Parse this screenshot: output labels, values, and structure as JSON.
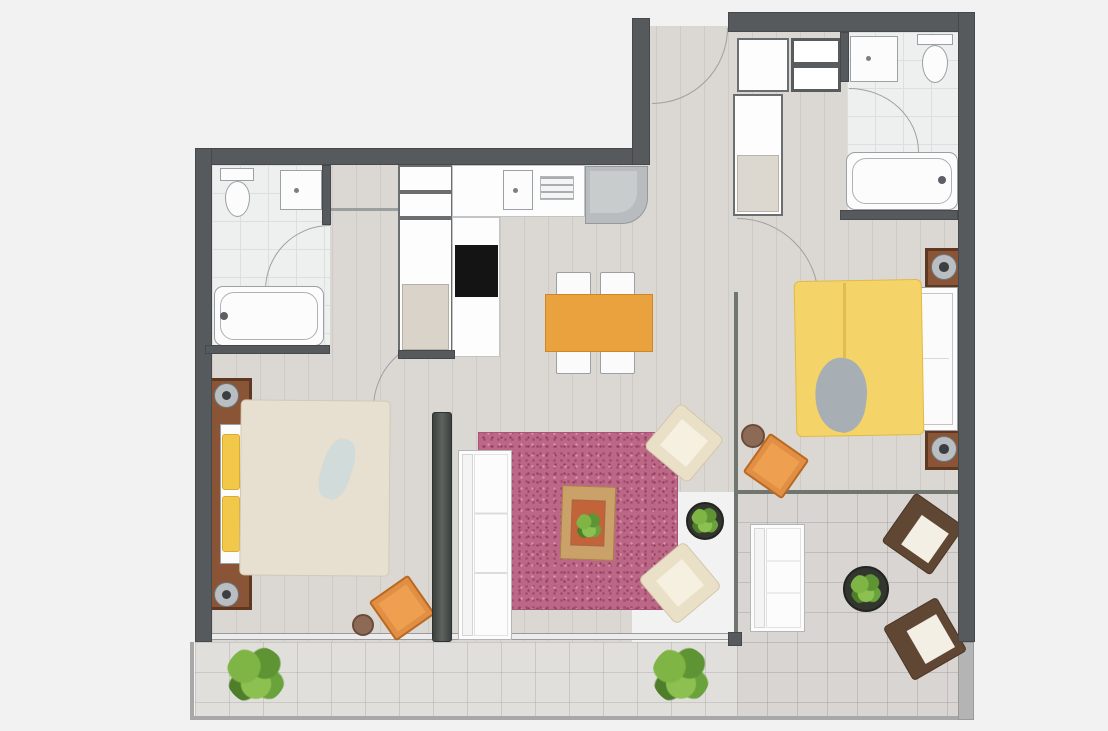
{
  "meta": {
    "kind": "apartment-floor-plan",
    "canvas": {
      "w": 1108,
      "h": 731
    },
    "background": "#f2f2f3"
  },
  "palette": {
    "wall": "#565a5d",
    "wood_floor": "#dbd7d2",
    "bath_tile": "#eef0f0",
    "terrace_tile": "#d8d5d2",
    "rug_pink": "#bd6787",
    "duvet_yellow": "#f4d469",
    "duvet_beige": "#e7e0d0",
    "accent_orange": "#e9a23e",
    "furniture_brown": "#5f4733",
    "plant_green": "#7fb544"
  },
  "scene": {
    "items": [
      {
        "name": "floor-left-wing",
        "cls": "floor-wood",
        "x": 212,
        "y": 165,
        "w": 420,
        "h": 477
      },
      {
        "name": "floor-right-wing",
        "cls": "floor-wood",
        "x": 632,
        "y": 26,
        "w": 326,
        "h": 466
      },
      {
        "name": "floor-bathroom-1",
        "cls": "floor-bath",
        "x": 212,
        "y": 165,
        "w": 118,
        "h": 182
      },
      {
        "name": "floor-bathroom-2",
        "cls": "floor-bath",
        "x": 847,
        "y": 32,
        "w": 111,
        "h": 182
      },
      {
        "name": "floor-terrace",
        "cls": "floor-terrace",
        "x": 737,
        "y": 492,
        "w": 221,
        "h": 226
      },
      {
        "name": "floor-balcony",
        "cls": "floor-balcony",
        "x": 195,
        "y": 642,
        "w": 542,
        "h": 76
      },
      {
        "name": "balcony-railing-left",
        "cls": "rail",
        "x": 190,
        "y": 642,
        "w": 4,
        "h": 78
      },
      {
        "name": "balcony-railing-bottom",
        "cls": "rail",
        "x": 190,
        "y": 716,
        "w": 772,
        "h": 4
      },
      {
        "name": "terrace-wall-right",
        "cls": "wall-light",
        "x": 958,
        "y": 642,
        "w": 16,
        "h": 78
      },
      {
        "name": "bedroom1-window",
        "cls": "window-line",
        "x": 212,
        "y": 633,
        "w": 220,
        "h": 7
      },
      {
        "name": "living-window",
        "cls": "window-line",
        "x": 452,
        "y": 633,
        "w": 281,
        "h": 7
      },
      {
        "name": "partition-living-terrace",
        "cls": "glass-line",
        "x": 734,
        "y": 292,
        "w": 4,
        "h": 348
      },
      {
        "name": "partition-bedroom2-terrace",
        "cls": "glass-line",
        "x": 738,
        "y": 490,
        "w": 220,
        "h": 4
      },
      {
        "name": "partition-post",
        "cls": "wall",
        "x": 728,
        "y": 632,
        "w": 14,
        "h": 14
      },
      {
        "name": "entrance-door-arc",
        "cls": "arc arc-tl",
        "x": 652,
        "y": 28,
        "w": 76,
        "h": 76
      },
      {
        "name": "bath1-door-arc",
        "cls": "arc arc-br",
        "x": 265,
        "y": 225,
        "w": 65,
        "h": 65
      },
      {
        "name": "bath2-door-arc",
        "cls": "arc arc-bl",
        "x": 849,
        "y": 88,
        "w": 70,
        "h": 64
      },
      {
        "name": "bedroom2-door-arc",
        "cls": "arc arc-bl",
        "x": 737,
        "y": 218,
        "w": 82,
        "h": 82
      },
      {
        "name": "bedroom1-door-arc",
        "cls": "arc arc-br",
        "x": 373,
        "y": 338,
        "w": 70,
        "h": 70
      },
      {
        "name": "toilet1-tank",
        "cls": "white-item",
        "x": 220,
        "y": 168,
        "w": 34,
        "h": 13
      },
      {
        "name": "toilet1-bowl",
        "cls": "white-item toilet-bowl",
        "x": 225,
        "y": 181,
        "w": 25,
        "h": 36
      },
      {
        "name": "bathroom1-sink",
        "cls": "white-item sink",
        "x": 280,
        "y": 170,
        "w": 42,
        "h": 40
      },
      {
        "name": "bathtub-1",
        "cls": "white-item tub",
        "x": 214,
        "y": 286,
        "w": 110,
        "h": 60
      },
      {
        "name": "bathtub1-faucet",
        "cls": "dark-dot",
        "x": 220,
        "y": 312,
        "w": 8,
        "h": 8
      },
      {
        "name": "hall-closet-shelf-a",
        "cls": "outline-item",
        "x": 398,
        "y": 165,
        "w": 55,
        "h": 27
      },
      {
        "name": "hall-closet-shelf-b",
        "cls": "outline-item",
        "x": 398,
        "y": 192,
        "w": 55,
        "h": 26
      },
      {
        "name": "hall-wardrobe",
        "cls": "outline-item",
        "x": 398,
        "y": 218,
        "w": 55,
        "h": 136
      },
      {
        "name": "hall-wardrobe-interior",
        "cls": "soft-fill",
        "x": 402,
        "y": 284,
        "w": 47,
        "h": 66,
        "bg": "#d9d3c9"
      },
      {
        "name": "hall-doorway-lintel",
        "cls": "thin-line",
        "x": 330,
        "y": 208,
        "w": 68,
        "h": 3
      },
      {
        "name": "kitchen-counter",
        "cls": "counter",
        "x": 452,
        "y": 165,
        "w": 133,
        "h": 52
      },
      {
        "name": "kitchen-counter-column",
        "cls": "counter",
        "x": 452,
        "y": 217,
        "w": 48,
        "h": 140
      },
      {
        "name": "kitchen-oven",
        "cls": "black-box",
        "x": 455,
        "y": 245,
        "w": 43,
        "h": 52
      },
      {
        "name": "kitchen-sink",
        "cls": "white-item sink",
        "x": 503,
        "y": 170,
        "w": 30,
        "h": 40
      },
      {
        "name": "kitchen-vent-grill",
        "cls": "grill",
        "x": 540,
        "y": 176,
        "w": 34,
        "h": 24
      },
      {
        "name": "kitchen-stove",
        "cls": "stove",
        "x": 585,
        "y": 166,
        "w": 63,
        "h": 58
      },
      {
        "name": "dining-chair-1",
        "cls": "chair-white",
        "x": 556,
        "y": 272,
        "w": 35,
        "h": 24
      },
      {
        "name": "dining-chair-2",
        "cls": "chair-white",
        "x": 600,
        "y": 272,
        "w": 35,
        "h": 24
      },
      {
        "name": "dining-chair-3",
        "cls": "chair-white",
        "x": 556,
        "y": 350,
        "w": 35,
        "h": 24
      },
      {
        "name": "dining-chair-4",
        "cls": "chair-white",
        "x": 600,
        "y": 350,
        "w": 35,
        "h": 24
      },
      {
        "name": "dining-table",
        "cls": "table-orange",
        "x": 545,
        "y": 294,
        "w": 108,
        "h": 58
      },
      {
        "name": "entry-closet-cabinet",
        "cls": "outline-item",
        "x": 737,
        "y": 38,
        "w": 52,
        "h": 54
      },
      {
        "name": "entry-closet-shelves",
        "cls": "shelves",
        "x": 791,
        "y": 38,
        "w": 50,
        "h": 54
      },
      {
        "name": "entry-wardrobe",
        "cls": "outline-item",
        "x": 733,
        "y": 94,
        "w": 50,
        "h": 122
      },
      {
        "name": "entry-wardrobe-interior",
        "cls": "soft-fill",
        "x": 737,
        "y": 155,
        "w": 42,
        "h": 57,
        "bg": "#ddd8cf"
      },
      {
        "name": "bathroom2-sink",
        "cls": "white-item sink",
        "x": 850,
        "y": 36,
        "w": 48,
        "h": 46
      },
      {
        "name": "toilet2-tank",
        "cls": "white-item",
        "x": 917,
        "y": 34,
        "w": 36,
        "h": 11
      },
      {
        "name": "toilet2-bowl",
        "cls": "white-item toilet-bowl",
        "x": 922,
        "y": 45,
        "w": 26,
        "h": 38
      },
      {
        "name": "bathtub-2",
        "cls": "white-item tub",
        "x": 846,
        "y": 152,
        "w": 112,
        "h": 58
      },
      {
        "name": "bathtub2-faucet",
        "cls": "dark-dot",
        "x": 938,
        "y": 176,
        "w": 8,
        "h": 8
      },
      {
        "name": "nightstand-1",
        "cls": "nightstand",
        "x": 925,
        "y": 248,
        "w": 38,
        "h": 40
      },
      {
        "name": "nightstand-lamp-1",
        "cls": "lamp",
        "x": 931,
        "y": 254,
        "w": 26,
        "h": 26
      },
      {
        "name": "nightstand-2",
        "cls": "nightstand",
        "x": 925,
        "y": 430,
        "w": 38,
        "h": 40
      },
      {
        "name": "nightstand-lamp-2",
        "cls": "lamp",
        "x": 931,
        "y": 436,
        "w": 26,
        "h": 26
      },
      {
        "name": "bed2-mattress",
        "cls": "white-item",
        "x": 910,
        "y": 287,
        "w": 48,
        "h": 144
      },
      {
        "name": "bed2-pillows",
        "cls": "pillow",
        "x": 913,
        "y": 293,
        "w": 40,
        "h": 132
      },
      {
        "name": "bed2-duvet",
        "cls": "duvet-yellow",
        "x": 795,
        "y": 280,
        "w": 128,
        "h": 156,
        "rot": -1
      },
      {
        "name": "bed2-duvet-fold",
        "cls": "fold-line",
        "x": 843,
        "y": 283,
        "w": 3,
        "h": 150
      },
      {
        "name": "bed2-throw",
        "cls": "throw-gray",
        "x": 815,
        "y": 358,
        "w": 52,
        "h": 74,
        "rot": 8
      },
      {
        "name": "pouf-2",
        "cls": "pouf",
        "x": 741,
        "y": 424,
        "w": 24,
        "h": 24
      },
      {
        "name": "armchair-orange-2",
        "cls": "chair-orange",
        "x": 752,
        "y": 442,
        "w": 48,
        "h": 48,
        "rot": 35
      },
      {
        "name": "bed1-headboard",
        "cls": "nightstand",
        "x": 208,
        "y": 378,
        "w": 44,
        "h": 232
      },
      {
        "name": "bed1-lamp-1",
        "cls": "lamp",
        "x": 214,
        "y": 383,
        "w": 25,
        "h": 25
      },
      {
        "name": "bed1-lamp-2",
        "cls": "lamp",
        "x": 214,
        "y": 582,
        "w": 25,
        "h": 25
      },
      {
        "name": "bed1-mattress",
        "cls": "white-item",
        "x": 220,
        "y": 424,
        "w": 44,
        "h": 140
      },
      {
        "name": "bed1-pillow-1",
        "cls": "pillow-yellow",
        "x": 222,
        "y": 434,
        "w": 18,
        "h": 56
      },
      {
        "name": "bed1-pillow-2",
        "cls": "pillow-yellow",
        "x": 222,
        "y": 496,
        "w": 18,
        "h": 56
      },
      {
        "name": "bed1-duvet",
        "cls": "duvet-beige",
        "x": 240,
        "y": 400,
        "w": 150,
        "h": 176,
        "rot": 0.5
      },
      {
        "name": "bed1-throw",
        "cls": "throw-blue",
        "x": 322,
        "y": 438,
        "w": 30,
        "h": 62,
        "rot": 18
      },
      {
        "name": "armchair-orange-1",
        "cls": "chair-orange",
        "x": 378,
        "y": 584,
        "w": 48,
        "h": 48,
        "rot": -35
      },
      {
        "name": "pouf-1",
        "cls": "pouf",
        "x": 352,
        "y": 614,
        "w": 22,
        "h": 22
      },
      {
        "name": "living-rug",
        "cls": "rug",
        "x": 478,
        "y": 432,
        "w": 200,
        "h": 178
      },
      {
        "name": "sofa",
        "cls": "sofa",
        "x": 458,
        "y": 450,
        "w": 54,
        "h": 190
      },
      {
        "name": "coffee-table",
        "cls": "coffee-table",
        "x": 561,
        "y": 486,
        "w": 54,
        "h": 74,
        "rot": 2
      },
      {
        "name": "coffee-table-tray",
        "cls": "soft-fill",
        "x": 571,
        "y": 500,
        "w": 34,
        "h": 46,
        "bg": "#c2633a",
        "rot": 2
      },
      {
        "name": "coffee-table-plant",
        "cls": "plant",
        "x": 576,
        "y": 512,
        "w": 26,
        "h": 28
      },
      {
        "name": "armchair-cream-1",
        "cls": "armchair-cream",
        "x": 655,
        "y": 414,
        "w": 58,
        "h": 58,
        "rot": 40
      },
      {
        "name": "armchair-cream-2",
        "cls": "armchair-cream",
        "x": 650,
        "y": 553,
        "w": 60,
        "h": 60,
        "rot": -40
      },
      {
        "name": "living-plant-table",
        "cls": "plant-table",
        "x": 686,
        "y": 502,
        "w": 38,
        "h": 38
      },
      {
        "name": "living-plant",
        "cls": "plant",
        "x": 691,
        "y": 507,
        "w": 28,
        "h": 28
      },
      {
        "name": "tv-partition-wall",
        "cls": "tv-wall",
        "x": 432,
        "y": 412,
        "w": 20,
        "h": 230
      },
      {
        "name": "terrace-loveseat",
        "cls": "sofa",
        "x": 750,
        "y": 524,
        "w": 55,
        "h": 108
      },
      {
        "name": "terrace-plant-table",
        "cls": "plant-table",
        "x": 843,
        "y": 566,
        "w": 46,
        "h": 46
      },
      {
        "name": "terrace-plant",
        "cls": "plant",
        "x": 850,
        "y": 573,
        "w": 32,
        "h": 32
      },
      {
        "name": "armchair-brown-1",
        "cls": "armchair-brown",
        "x": 893,
        "y": 504,
        "w": 60,
        "h": 60,
        "rot": 35
      },
      {
        "name": "armchair-brown-2",
        "cls": "armchair-brown",
        "x": 894,
        "y": 608,
        "w": 62,
        "h": 62,
        "rot": -30
      },
      {
        "name": "balcony-plant-1",
        "cls": "plant",
        "x": 226,
        "y": 646,
        "w": 60,
        "h": 58
      },
      {
        "name": "balcony-plant-2",
        "cls": "plant",
        "x": 652,
        "y": 646,
        "w": 58,
        "h": 58
      },
      {
        "name": "wall-top-left",
        "cls": "wall",
        "x": 195,
        "y": 148,
        "w": 455,
        "h": 17
      },
      {
        "name": "wall-left",
        "cls": "wall",
        "x": 195,
        "y": 148,
        "w": 17,
        "h": 494
      },
      {
        "name": "wall-entry-left",
        "cls": "wall",
        "x": 632,
        "y": 18,
        "w": 18,
        "h": 147
      },
      {
        "name": "wall-top-right",
        "cls": "wall",
        "x": 728,
        "y": 12,
        "w": 247,
        "h": 20
      },
      {
        "name": "wall-right",
        "cls": "wall",
        "x": 958,
        "y": 12,
        "w": 17,
        "h": 630
      },
      {
        "name": "wall-bath2-left",
        "cls": "wall",
        "x": 840,
        "y": 32,
        "w": 9,
        "h": 50
      },
      {
        "name": "wall-bath2-bottom",
        "cls": "wall",
        "x": 840,
        "y": 210,
        "w": 118,
        "h": 10
      },
      {
        "name": "wall-bath1-right",
        "cls": "wall",
        "x": 322,
        "y": 165,
        "w": 9,
        "h": 60
      },
      {
        "name": "wall-bath1-bottom",
        "cls": "wall",
        "x": 205,
        "y": 345,
        "w": 125,
        "h": 9
      },
      {
        "name": "wall-hall-stub",
        "cls": "wall",
        "x": 398,
        "y": 350,
        "w": 57,
        "h": 9
      }
    ]
  }
}
